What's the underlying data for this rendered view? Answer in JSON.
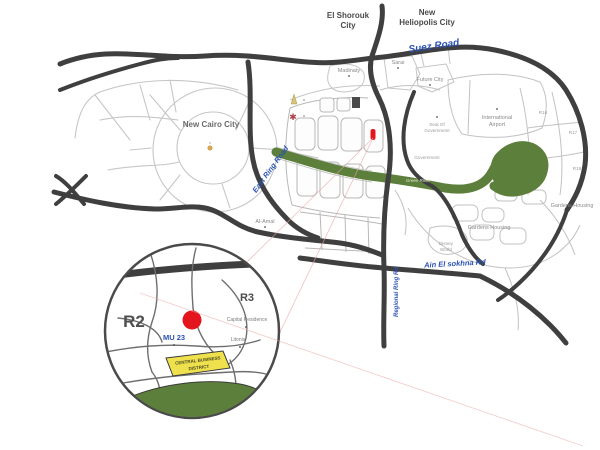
{
  "map": {
    "cities": {
      "el_shorouk": {
        "line1": "El Shorouk",
        "line2": "City"
      },
      "new_heliopolis": {
        "line1": "New",
        "line2": "Heliopolis City"
      },
      "new_cairo": "New Cairo City"
    },
    "roads": {
      "suez": "Suez Road",
      "east_ring": "East Ring Road",
      "regional_ring": "Regional Ring Rd",
      "ain_sokhna": "Ain El sokhna Rd"
    },
    "places": {
      "madinaty": "Madinaty",
      "sarai": "Sarai",
      "future_city": "Future City",
      "al_amal": "Al-Amal",
      "seat_of_government": {
        "line1": "Seat Of",
        "line2": "Government"
      },
      "government": "Government",
      "green_river": "Green River",
      "international_airport": {
        "line1": "International",
        "line2": "Airport"
      },
      "gardens_housing": "Gardens Housing",
      "disney_world": {
        "line1": "Disney",
        "line2": "World"
      },
      "parcels": {
        "r16": "R16",
        "r17": "R17",
        "r18": "R18"
      }
    },
    "inset": {
      "district_r2": "R2",
      "district_r3": "R3",
      "mu23": "MU 23",
      "capital_residence": "Capital Residence",
      "litonis": "Litonis",
      "cbd": {
        "line1": "CENTRAL BUSINESS",
        "line2": "DISTRICT"
      }
    },
    "icons": {
      "rosette_glyph": "✱"
    },
    "colors": {
      "road_dark": "#3f3f3f",
      "road_light": "#c6c6c6",
      "road_label_blue": "#2b52b4",
      "green": "#5c7f3b",
      "cbd_yellow": "#efe14e",
      "marker_red": "#e2161c",
      "pink_leader": "#e8a6a6",
      "label_gray": "#4a4a4a"
    }
  }
}
